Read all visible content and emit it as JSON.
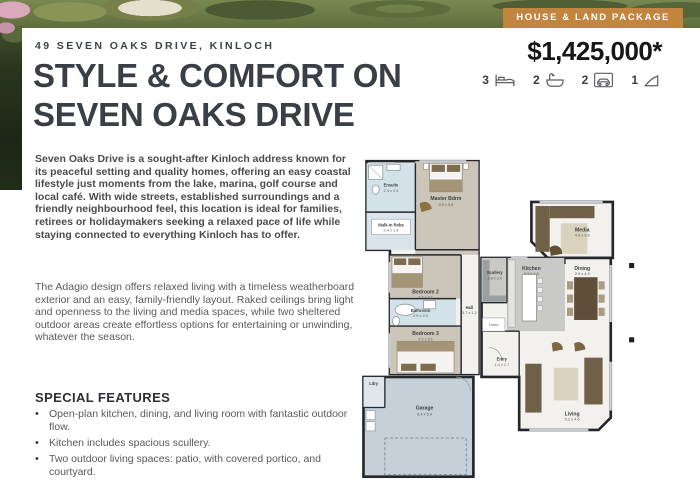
{
  "badge": {
    "label": "HOUSE & LAND PACKAGE",
    "bg_color": "#c28540"
  },
  "header": {
    "address_eyebrow": "49 SEVEN OAKS DRIVE, KINLOCH",
    "headline_line1": "STYLE & COMFORT ON",
    "headline_line2": "SEVEN OAKS DRIVE",
    "price": "$1,425,000*"
  },
  "stats": [
    {
      "value": "3",
      "icon": "bed-icon"
    },
    {
      "value": "2",
      "icon": "bath-icon"
    },
    {
      "value": "2",
      "icon": "car-garage-icon"
    },
    {
      "value": "1",
      "icon": "living-area-icon"
    }
  ],
  "body": {
    "intro_paragraph": "Seven Oaks Drive is a sought-after Kinloch address known for its peaceful setting and quality homes, offering an easy coastal lifestyle just moments from the lake, marina, golf course and local café. With wide streets, established surroundings and a friendly neighbourhood feel, this location is ideal for families, retirees or holidaymakers seeking a relaxed pace of life while staying connected to everything Kinloch has to offer.",
    "design_paragraph": "The Adagio design offers relaxed living with a timeless weatherboard exterior and an easy, family-friendly layout. Raked ceilings bring light and openness to the living and media spaces, while two sheltered outdoor areas create effortless options for entertaining or unwinding, whatever the season."
  },
  "features": {
    "title": "SPECIAL FEATURES",
    "items": [
      "Open-plan kitchen, dining, and living room with fantastic outdoor flow.",
      "Kitchen includes spacious scullery.",
      "Two outdoor living spaces: patio, with covered portico, and courtyard."
    ]
  },
  "floorplan": {
    "rooms": [
      {
        "name": "Ensuite",
        "dims": "2.4 x 2.2"
      },
      {
        "name": "Walk-in Robe",
        "dims": "2.4 x 1.9"
      },
      {
        "name": "Master Bdrm",
        "dims": "3.9 x 3.5"
      },
      {
        "name": "Bedroom 2",
        "dims": "3.2 x 3.1"
      },
      {
        "name": "Bathroom",
        "dims": "2.9 x 2.0"
      },
      {
        "name": "Hall",
        "dims": "3.7 x 1.2"
      },
      {
        "name": "Bedroom 3",
        "dims": "3.0 x 3.1"
      },
      {
        "name": "Ldry",
        "dims": ""
      },
      {
        "name": "Garage",
        "dims": "6.4 x 5.9"
      },
      {
        "name": "Scullery",
        "dims": "1.8 x 2.0"
      },
      {
        "name": "Kitchen",
        "dims": "3.0 x 4.3"
      },
      {
        "name": "Dining",
        "dims": "2.9 x 4.3"
      },
      {
        "name": "Media",
        "dims": "4.6 x 3.8"
      },
      {
        "name": "Living",
        "dims": "5.2 x 4.6"
      },
      {
        "name": "Entry",
        "dims": "1.4 x 1.7"
      },
      {
        "name": "Linen",
        "dims": ""
      }
    ]
  },
  "colors": {
    "badge_orange": "#c28540",
    "headline_charcoal": "#3a3f46",
    "plan_wall": "#24272c",
    "plan_bedroom_floor": "#ccc5b9",
    "plan_wet_area_floor": "#d3e2e8",
    "plan_garage_floor": "#c6d0d9",
    "plan_kitchen_floor": "#c9c9c5",
    "plan_furniture_brown": "#6f6148"
  }
}
